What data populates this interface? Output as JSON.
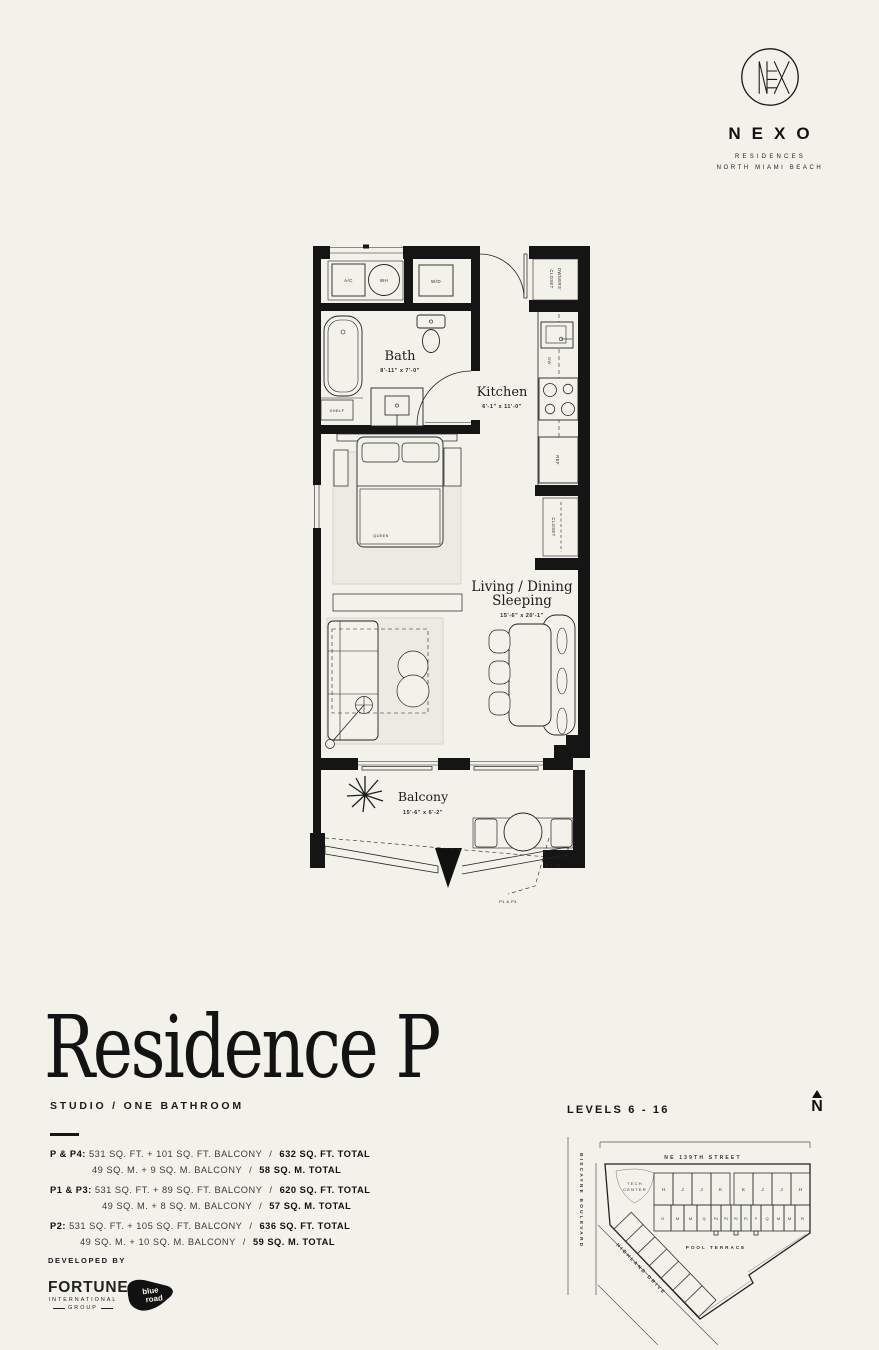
{
  "brand": {
    "name": "NEXO",
    "residences": "RESIDENCES",
    "location": "NORTH MIAMI BEACH"
  },
  "floorplan": {
    "bath": {
      "name": "Bath",
      "dims": "8'-11\" x 7'-0\""
    },
    "kitchen": {
      "name": "Kitchen",
      "dims": "6'-1\" x 11'-0\""
    },
    "living": {
      "line1": "Living / Dining",
      "line2": "Sleeping",
      "dims": "15'-6\" x 20'-1\""
    },
    "balcony": {
      "name": "Balcony",
      "dims": "15'-6\" x 6'-2\""
    },
    "fixtures": {
      "ac": "A/C",
      "wh": "WH",
      "wd": "W/D",
      "owners_closet_1": "OWNERS'",
      "owners_closet_2": "CLOSET",
      "dw": "DW",
      "ref": "REF",
      "closet": "CLOSET",
      "shelf": "SHELF",
      "queen": "QUEEN"
    },
    "callouts": {
      "p_p4": "P & P4",
      "p1_p3": "P1 & P3"
    }
  },
  "title": {
    "name": "Residence P",
    "subtitle": "STUDIO / ONE BATHROOM"
  },
  "areas": {
    "sep": "/",
    "items": [
      {
        "label": "P & P4:",
        "ft": "531 SQ. FT. + 101 SQ. FT. BALCONY",
        "ft_total": "632 SQ. FT. TOTAL",
        "m": "49 SQ. M. + 9 SQ. M. BALCONY",
        "m_total": "58 SQ. M. TOTAL"
      },
      {
        "label": "P1 & P3:",
        "ft": "531 SQ. FT. + 89 SQ. FT. BALCONY",
        "ft_total": "620 SQ. FT. TOTAL",
        "m": "49 SQ. M. + 8 SQ. M. BALCONY",
        "m_total": "57 SQ. M. TOTAL"
      },
      {
        "label": "P2:",
        "ft": "531 SQ. FT. + 105 SQ. FT. BALCONY",
        "ft_total": "636 SQ. FT. TOTAL",
        "m": "49 SQ. M. + 10 SQ. M. BALCONY",
        "m_total": "59 SQ. M. TOTAL"
      }
    ]
  },
  "developer": {
    "heading": "DEVELOPED BY",
    "fortune_1": "FORTUNE",
    "fortune_2": "INTERNATIONAL",
    "fortune_3": "GROUP",
    "blueroad_1": "blue",
    "blueroad_2": "road"
  },
  "siteplan": {
    "levels": "LEVELS 6 - 16",
    "north": "N",
    "street_top": "NE 139TH STREET",
    "street_left": "BISCAYNE BOULEVARD",
    "street_diag": "HIGHLAND DRIVE",
    "tech_center_1": "TECH",
    "tech_center_2": "CENTER",
    "pool": "POOL TERRACE",
    "row1": [
      "H",
      "J",
      "J",
      "K",
      "K",
      "J",
      "J",
      "H"
    ],
    "row2": [
      "O",
      "M",
      "M",
      "Q",
      "P4",
      "P3",
      "P2",
      "P1",
      "P",
      "Q",
      "M",
      "M",
      "R"
    ],
    "highlight_color": "#c9c8c1"
  },
  "colors": {
    "background": "#f2f1ea",
    "ink": "#151515"
  }
}
